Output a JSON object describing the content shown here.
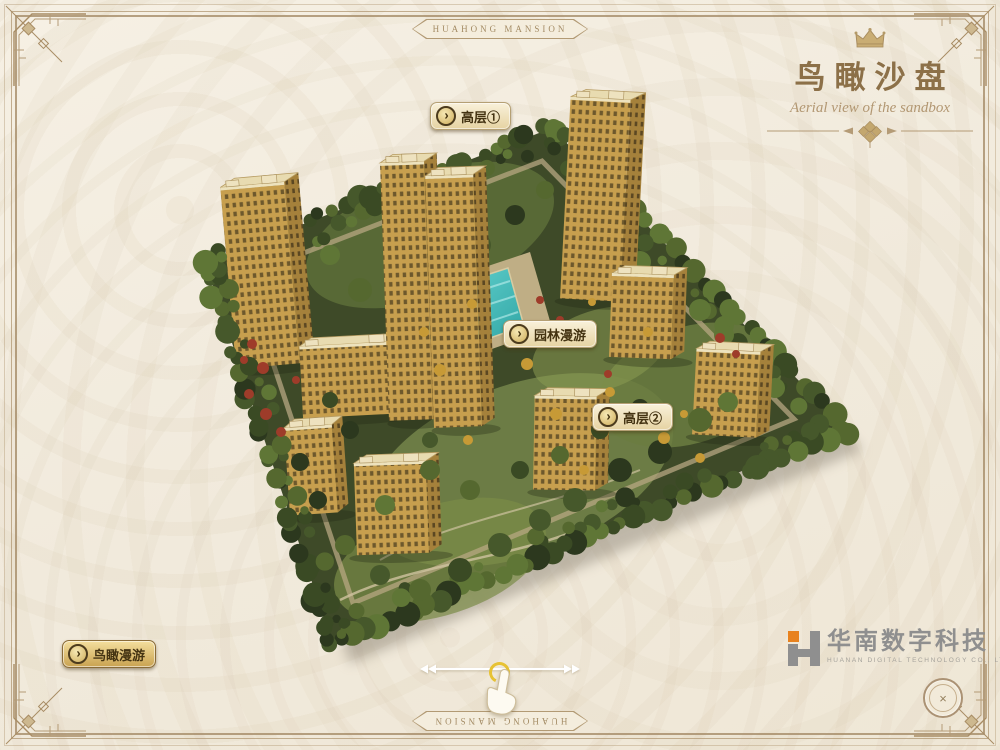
{
  "frame": {
    "top_label": "HUAHONG MANSION",
    "bottom_label": "HUAHONG MANSION"
  },
  "title": {
    "heading": "鸟瞰沙盘",
    "subtitle": "Aerial view of the sandbox"
  },
  "markers": {
    "arrow_glyph": "›",
    "highrise1": {
      "label": "高层①"
    },
    "garden": {
      "label": "园林漫游"
    },
    "highrise2": {
      "label": "高层②"
    },
    "aerial": {
      "label": "鸟瞰漫游"
    }
  },
  "logo": {
    "company": "华南数字科技",
    "company_en": "HUANAN DIGITAL TECHNOLOGY CO., LTD"
  },
  "close_button": {
    "icon": "×"
  },
  "colors": {
    "background": "#f3ecdf",
    "frame_line": "#a88c64",
    "title_gold": "#8c7048",
    "button_face": "#f0e3bd",
    "button_gold": "#d9b96a",
    "building_gold": "#c79f4e",
    "tree_dark_green": "#3a4a24",
    "pool_turquoise": "#45c0bd",
    "logo_gray": "#8f8f8f",
    "logo_orange": "#e8821e"
  }
}
